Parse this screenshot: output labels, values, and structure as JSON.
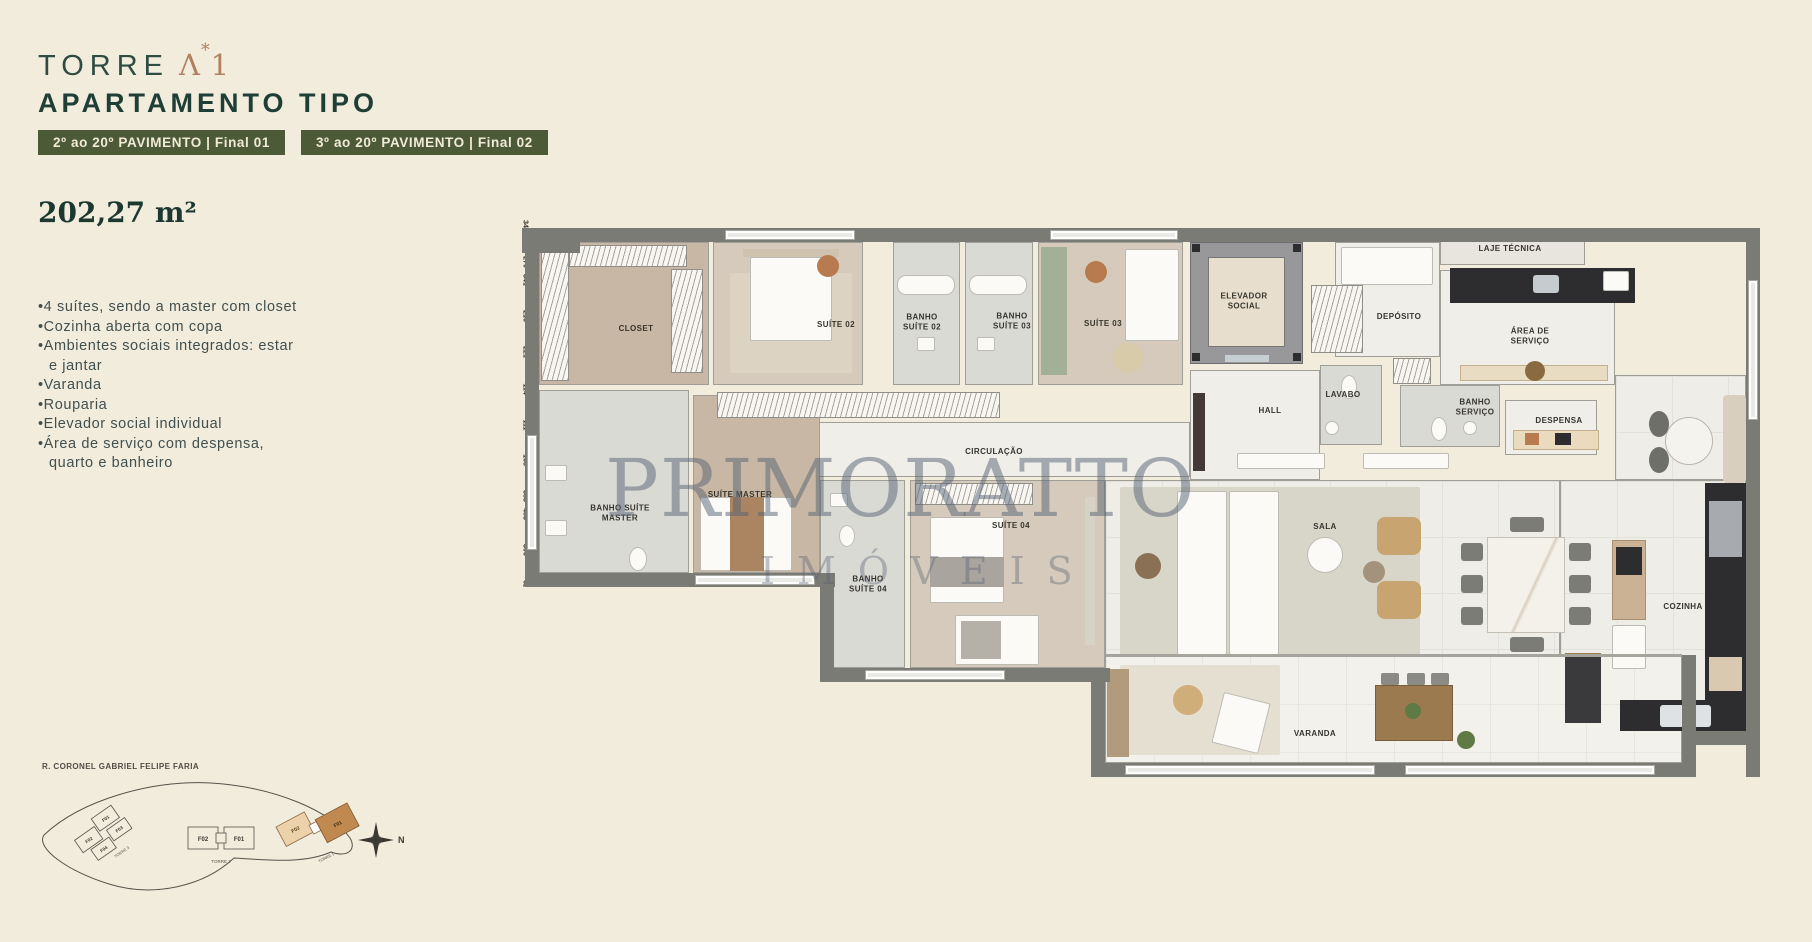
{
  "colors": {
    "background": "#f2ecdd",
    "badge_green": "#4d5a38",
    "dark_green": "#1f3e36",
    "copper": "#b0815e",
    "wall_gray": "#7b7b76",
    "watermark_blue": "#566173"
  },
  "header": {
    "brand": "TORRE",
    "mark": {
      "lambda": "Λ",
      "star": "*",
      "one": "1"
    },
    "title": "APARTAMENTO TIPO",
    "badges": [
      {
        "label": "2º ao 20º PAVIMENTO | Final 01"
      },
      {
        "label": "3º ao 20º PAVIMENTO | Final 02"
      }
    ],
    "area": "202,27 m²"
  },
  "features": [
    "4 suítes, sendo a master com closet",
    "Cozinha aberta com copa",
    "Ambientes sociais integrados: estar e jantar",
    "Varanda",
    "Rouparia",
    "Elevador social individual",
    "Área de serviço com despensa, quarto e banheiro"
  ],
  "floorplan": {
    "watermark": {
      "line1": "PRIMORATTO",
      "line2": "IMÓVEIS"
    },
    "rooms": [
      {
        "label": "CLOSET"
      },
      {
        "label": "SUÍTE 02"
      },
      {
        "label": "BANHO SUÍTE 02"
      },
      {
        "label": "BANHO SUÍTE 03"
      },
      {
        "label": "SUÍTE 03"
      },
      {
        "label": "ELEVADOR SOCIAL"
      },
      {
        "label": "DEPÓSITO"
      },
      {
        "label": "LAJE TÉCNICA"
      },
      {
        "label": "ÁREA DE SERVIÇO"
      },
      {
        "label": "HALL"
      },
      {
        "label": "LAVABO"
      },
      {
        "label": "BANHO SERVIÇO"
      },
      {
        "label": "DESPENSA"
      },
      {
        "label": "CIRCULAÇÃO"
      },
      {
        "label": "BANHO SUÍTE MASTER"
      },
      {
        "label": "SUÍTE MASTER"
      },
      {
        "label": "BANHO SUÍTE 04"
      },
      {
        "label": "SUÍTE 04"
      },
      {
        "label": "SALA"
      },
      {
        "label": "COZINHA"
      },
      {
        "label": "VARANDA"
      }
    ],
    "dimensions": [
      {
        "t": "341",
        "x": 283,
        "y": 24,
        "v": 1
      },
      {
        "t": "279",
        "x": 348,
        "y": 24,
        "v": 1
      },
      {
        "t": "279",
        "x": 506,
        "y": 20,
        "v": 1
      },
      {
        "t": "341",
        "x": 523,
        "y": 20,
        "v": 1
      },
      {
        "t": "279",
        "x": 648,
        "y": 158,
        "v": 0
      },
      {
        "t": "216",
        "x": 928,
        "y": 52,
        "v": 1
      },
      {
        "t": "189",
        "x": 896,
        "y": 66,
        "v": 0
      },
      {
        "t": "221",
        "x": 843,
        "y": 124,
        "v": 1
      },
      {
        "t": "429",
        "x": 917,
        "y": 158,
        "v": 0
      },
      {
        "t": "207",
        "x": 858,
        "y": 174,
        "v": 0
      },
      {
        "t": "114",
        "x": 1004,
        "y": 180,
        "v": 1
      },
      {
        "t": "172",
        "x": 1074,
        "y": 226,
        "v": 0
      },
      {
        "t": "123",
        "x": 828,
        "y": 226,
        "v": 0
      },
      {
        "t": "111",
        "x": 848,
        "y": 216,
        "v": 1
      },
      {
        "t": "190",
        "x": 774,
        "y": 143,
        "v": 0
      },
      {
        "t": "168",
        "x": 799,
        "y": 148,
        "v": 1
      },
      {
        "t": "251",
        "x": 174,
        "y": 160,
        "v": 0
      },
      {
        "t": "301",
        "x": 199,
        "y": 160,
        "v": 0
      },
      {
        "t": "142",
        "x": 424,
        "y": 159,
        "v": 0
      },
      {
        "t": "130",
        "x": 449,
        "y": 159,
        "v": 0
      },
      {
        "t": "185",
        "x": 38,
        "y": 228,
        "v": 0
      },
      {
        "t": "383",
        "x": 126,
        "y": 212,
        "v": 1
      },
      {
        "t": "453",
        "x": 189,
        "y": 212,
        "v": 1
      },
      {
        "t": "301",
        "x": 541,
        "y": 298,
        "v": 0
      },
      {
        "t": "957",
        "x": 561,
        "y": 435,
        "v": 0
      },
      {
        "t": "407",
        "x": 53,
        "y": 348,
        "v": 0
      },
      {
        "t": "301",
        "x": 194,
        "y": 349,
        "v": 0
      },
      {
        "t": "341",
        "x": 319,
        "y": 349,
        "v": 0
      },
      {
        "t": "390",
        "x": 1077,
        "y": 434,
        "v": 1
      },
      {
        "t": "892",
        "x": 1059,
        "y": 462,
        "v": 0
      },
      {
        "t": "627",
        "x": 1095,
        "y": 499,
        "v": 1
      },
      {
        "t": "256",
        "x": 1221,
        "y": 471,
        "v": 0
      },
      {
        "t": "211",
        "x": 1163,
        "y": 490,
        "v": 1
      }
    ]
  },
  "siteplan": {
    "street": "R. CORONEL GABRIEL FELIPE FARIA",
    "torre3": {
      "name": "TORRE 3",
      "units": [
        "F02",
        "F01",
        "F04",
        "F03"
      ]
    },
    "torre2": {
      "name": "TORRE 2",
      "units": [
        "F02",
        "F01"
      ]
    },
    "torre1": {
      "name": "TORRE 1",
      "units": [
        "F02",
        "F01"
      ]
    },
    "compass": "N"
  }
}
